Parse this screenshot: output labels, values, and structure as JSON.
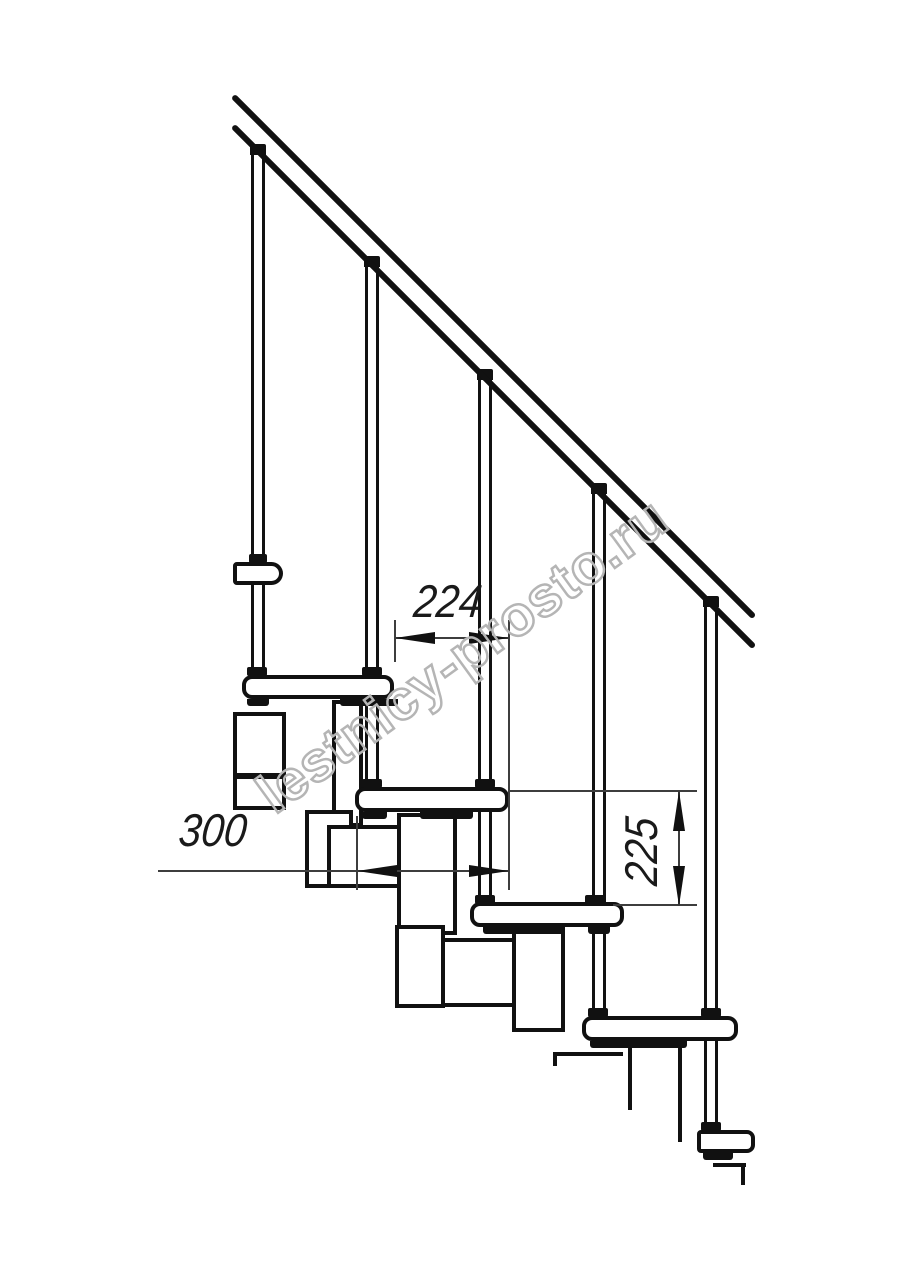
{
  "dimensions": {
    "going": "224",
    "tread_depth": "300",
    "riser": "225"
  },
  "watermark": {
    "text": "lestnicy-prosto.ru"
  },
  "colors": {
    "line": "#111111",
    "dimension_line": "#3d3d3d",
    "dimension_text": "#1a1a1a",
    "watermark": "#b5b5b5",
    "background": "#ffffff"
  }
}
